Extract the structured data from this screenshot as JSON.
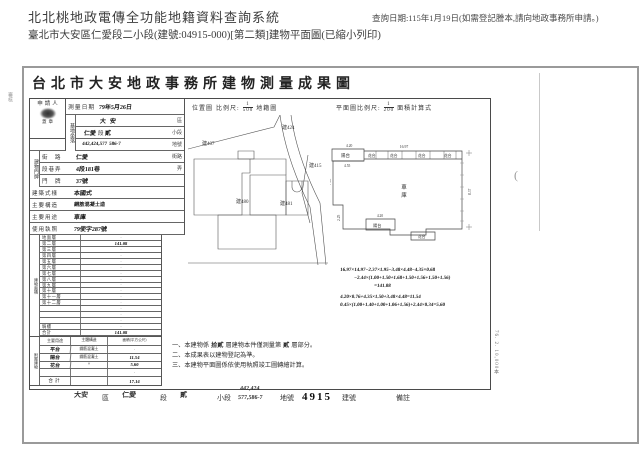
{
  "header": {
    "system_title": "北北桃地政電傳全功能地籍資料查詢系統",
    "query_date": "查詢日期:115年1月19日(如需登記謄本,請向地政事務所申請。)",
    "subtitle": "臺北市大安區仁愛段二小段(建號:04915-000)[第二類]建物平面圖(已縮小列印)"
  },
  "doc": {
    "title": "台北市大安地政事務所建物測量成果圖",
    "print_note": "76. 2. 10,000本",
    "margin_review_note": "審核",
    "margin_section_note": "段二小段",
    "margin_number_note": "10/5",
    "scan_artifact": "("
  },
  "form": {
    "applicant": {
      "label": "申請人",
      "stamp_label": "蓋章"
    },
    "survey": {
      "label": "測量日期",
      "value": "79年5月26日"
    },
    "location_header": {
      "label": "位置圖",
      "scale_label": "比例尺:",
      "numerator": "1",
      "denominator": "500",
      "suffix": "地籍圖"
    },
    "plan_header": {
      "label": "平面圖比例尺:",
      "numerator": "1",
      "denominator": "200",
      "suffix": "面積計算式"
    },
    "site": {
      "group": "基地坐落",
      "district": {
        "hw": "大安",
        "suffix": "區"
      },
      "section": {
        "hw1": "仁愛",
        "mid": "段",
        "hw2": "貳",
        "suffix": "小段"
      },
      "lots": {
        "hw1": "442,424,577",
        "hw2": "586-7",
        "suffix": "地號"
      }
    },
    "address": {
      "group": "建物門牌",
      "street": {
        "label": "街　路",
        "hw": "仁愛",
        "suffix": "街路"
      },
      "lane": {
        "label": "段巷弄",
        "hw": "4段181巷",
        "suffix": "弄"
      },
      "door": {
        "label": "門　牌",
        "hw": "37號",
        "suffix": ""
      }
    },
    "attrs": [
      {
        "label": "建築式樣",
        "value": "本國式"
      },
      {
        "label": "主要構造",
        "value": "鋼筋混凝土造"
      },
      {
        "label": "主要用途",
        "value": "車庫"
      },
      {
        "label": "使用執照",
        "value": "79使字287號"
      }
    ],
    "floor_group": "建物面積",
    "floor_group_unit": "(平方公尺)",
    "floors": [
      {
        "label": "地面層",
        "value": "·"
      },
      {
        "label": "第二層",
        "value": "141.08"
      },
      {
        "label": "第三層",
        "value": "·"
      },
      {
        "label": "第四層",
        "value": "·"
      },
      {
        "label": "第五層",
        "value": "·"
      },
      {
        "label": "第六層",
        "value": "·"
      },
      {
        "label": "第七層",
        "value": "·"
      },
      {
        "label": "第八層",
        "value": "·"
      },
      {
        "label": "第九層",
        "value": "·"
      },
      {
        "label": "第十層",
        "value": "·"
      },
      {
        "label": "第十一層",
        "value": "·"
      },
      {
        "label": "第十二層",
        "value": "·"
      },
      {
        "label": "",
        "value": "·"
      },
      {
        "label": "",
        "value": "·"
      },
      {
        "label": "",
        "value": "·"
      },
      {
        "label": "騎樓",
        "value": "·"
      },
      {
        "label": "合計",
        "value": "141.08"
      }
    ],
    "attached": {
      "group": "附屬建物",
      "headers": [
        "主要用途",
        "主體構造",
        "面積(平方公尺)"
      ],
      "rows": [
        {
          "use": "平台",
          "struct": "鋼筋混凝土",
          "area": "·"
        },
        {
          "use": "陽台",
          "struct": "鋼筋混凝土",
          "area": "11.54"
        },
        {
          "use": "花台",
          "struct": "〃",
          "area": "5.60"
        },
        {
          "use": "",
          "struct": "",
          "area": "·"
        },
        {
          "use": "合計",
          "struct": "",
          "area": "17.14"
        }
      ]
    },
    "notes": {
      "n1a": "一、本建物係",
      "n1hw1": "拾貳",
      "n1b": "層建物本件僅測量第",
      "n1hw2": "貳",
      "n1c": "層部分。",
      "n2": "二、本成果表以建物登記為準。",
      "n3": "三、本建物平面圖係依使用執照竣工圖轉繪計算。"
    },
    "formulas": [
      "16.97×14.97−2.37×1.95−3.48×4.48−4.35×0.68",
      "−2.44×(1.00+1.50+1.68+1.50+1.56+1.50+1.56)",
      "=141.08",
      "4.20×0.76+4.35×1.50+3.48×4.48=11.54",
      "0.45×(1.00+1.40+1.00+1.06+1.56)+2.44×0.34=5.60"
    ]
  },
  "location_map": {
    "labels": [
      "建407",
      "建424",
      "建415",
      "建480",
      "建481"
    ]
  },
  "floor_plan": {
    "balcony_top": "陽台",
    "balcony_bottom": "陽台",
    "garage_1": "車",
    "garage_2": "庫",
    "flower_labels": [
      "花台",
      "花台",
      "花台",
      "花台"
    ],
    "flower_bottom": "花台",
    "dims": {
      "top_width": "16.97",
      "balcony_top_w": "4.20",
      "balcony_top_inner": "4.55",
      "left_upper": "7.05",
      "left_lower": "2.25",
      "right_height": "8.37",
      "balcony_bottom_w": "4.20"
    }
  },
  "footer_strip": {
    "district_hw": "大安",
    "district": "區",
    "section_hw": "仁愛",
    "section": "段",
    "subsection_hw": "貳",
    "subsection": "小段",
    "lots_hw1": "442,424",
    "lots_hw2": "577,586-7",
    "lots": "地號",
    "building_no": "4915",
    "building_no_label": "建號",
    "remark": "備註"
  }
}
